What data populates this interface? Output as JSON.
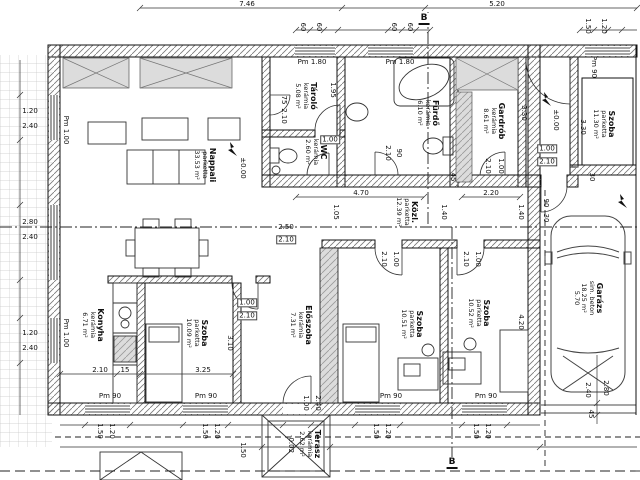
{
  "drawing": {
    "type": "architectural floor plan",
    "level_markers": [
      "±0.00",
      "±0.00",
      "-0.02"
    ],
    "section_marker": "B"
  },
  "colors": {
    "line": "#111111",
    "wall_hatch": "#666666",
    "grey_fill": "#d9d9d9",
    "grid_line": "#c8c8c8"
  },
  "rooms": [
    {
      "name": "Nappali",
      "floor": "parketta",
      "area": "33.53 m²",
      "x": 205,
      "y": 165
    },
    {
      "name": "Tároló",
      "floor": "kerámia",
      "area": "5.08 m²",
      "x": 306,
      "y": 96
    },
    {
      "name": "Fürdő",
      "floor": "kerámia",
      "area": "6.10 m²",
      "x": 428,
      "y": 113
    },
    {
      "name": "WC",
      "floor": "kerámia",
      "area": "2.60 m²",
      "x": 316,
      "y": 152
    },
    {
      "name": "Gardrób",
      "floor": "kerámia",
      "area": "8.61 m²",
      "x": 494,
      "y": 121
    },
    {
      "name": "Szoba",
      "floor": "parketta",
      "area": "11.30 m²",
      "x": 604,
      "y": 124
    },
    {
      "name": "Közl.",
      "floor": "parketta",
      "area": "12.39 m²",
      "x": 407,
      "y": 212
    },
    {
      "name": "Konyha",
      "floor": "kerámia",
      "area": "6.71 m²",
      "x": 93,
      "y": 325
    },
    {
      "name": "Szoba",
      "floor": "parketta",
      "area": "10.09 m²",
      "x": 197,
      "y": 333
    },
    {
      "name": "Előszoba",
      "floor": "kerámia",
      "area": "7.31 m²",
      "x": 301,
      "y": 325
    },
    {
      "name": "Szoba",
      "floor": "parketta",
      "area": "10.51 m²",
      "x": 412,
      "y": 324
    },
    {
      "name": "Szoba",
      "floor": "parketta",
      "area": "10.52 m²",
      "x": 479,
      "y": 313
    },
    {
      "name": "Garázs",
      "floor": "sim. beton",
      "area": "18.25 m²",
      "extra": "5.70",
      "x": 588,
      "y": 298
    },
    {
      "name": "Terasz",
      "floor": "kerámia",
      "area": "2.62 m²",
      "x": 310,
      "y": 444
    }
  ],
  "dimension_texts": [
    {
      "t": "7.46",
      "x": 247,
      "y": 4
    },
    {
      "t": "5.20",
      "x": 497,
      "y": 4
    },
    {
      "t": "B",
      "x": 424,
      "y": 19,
      "cls": "sec"
    },
    {
      "t": "60",
      "x": 303,
      "y": 27,
      "r": 1
    },
    {
      "t": "60",
      "x": 319,
      "y": 27,
      "r": 1
    },
    {
      "t": "60",
      "x": 394,
      "y": 27,
      "r": 1
    },
    {
      "t": "60",
      "x": 410,
      "y": 27,
      "r": 1
    },
    {
      "t": "1.50",
      "x": 588,
      "y": 26,
      "r": 1
    },
    {
      "t": "1.20",
      "x": 604,
      "y": 26,
      "r": 1
    },
    {
      "t": "Pm 90",
      "x": 594,
      "y": 67,
      "r": 1
    },
    {
      "t": "Pm 1.80",
      "x": 312,
      "y": 62
    },
    {
      "t": "Pm 1.80",
      "x": 400,
      "y": 62
    },
    {
      "t": "1.20",
      "x": 30,
      "y": 111
    },
    {
      "t": "2.40",
      "x": 30,
      "y": 126
    },
    {
      "t": "2.80",
      "x": 30,
      "y": 222
    },
    {
      "t": "2.40",
      "x": 30,
      "y": 237
    },
    {
      "t": "1.20",
      "x": 30,
      "y": 333
    },
    {
      "t": "2.40",
      "x": 30,
      "y": 348
    },
    {
      "t": "Pm 1.00",
      "x": 66,
      "y": 130,
      "r": 1
    },
    {
      "t": "Pm 1.00",
      "x": 66,
      "y": 333,
      "r": 1
    },
    {
      "t": "±0.00",
      "x": 243,
      "y": 168,
      "r": 1
    },
    {
      "t": "±0.00",
      "x": 556,
      "y": 120,
      "r": 1
    },
    {
      "t": "75",
      "x": 284,
      "y": 100,
      "r": 1
    },
    {
      "t": "2.10",
      "x": 284,
      "y": 116,
      "r": 1
    },
    {
      "t": "1.95",
      "x": 333,
      "y": 90,
      "r": 1
    },
    {
      "t": "1.00",
      "x": 330,
      "y": 140,
      "cls": "box"
    },
    {
      "t": "2.10",
      "x": 388,
      "y": 153,
      "r": 1
    },
    {
      "t": "90",
      "x": 399,
      "y": 153,
      "r": 1
    },
    {
      "t": "45",
      "x": 453,
      "y": 177,
      "r": 1
    },
    {
      "t": "3.30",
      "x": 524,
      "y": 113,
      "r": 1
    },
    {
      "t": "2.10",
      "x": 488,
      "y": 166,
      "r": 1
    },
    {
      "t": "1.00",
      "x": 501,
      "y": 166,
      "r": 1
    },
    {
      "t": "1.00",
      "x": 547,
      "y": 149,
      "cls": "box"
    },
    {
      "t": "2.10",
      "x": 547,
      "y": 162,
      "cls": "box"
    },
    {
      "t": "3.30",
      "x": 583,
      "y": 127,
      "r": 1
    },
    {
      "t": "30",
      "x": 592,
      "y": 177,
      "r": 1
    },
    {
      "t": "4.70",
      "x": 361,
      "y": 193
    },
    {
      "t": "2.20",
      "x": 491,
      "y": 193
    },
    {
      "t": "1.05",
      "x": 336,
      "y": 212,
      "r": 1
    },
    {
      "t": "1.40",
      "x": 444,
      "y": 212,
      "r": 1
    },
    {
      "t": "1.40",
      "x": 521,
      "y": 212,
      "r": 1
    },
    {
      "t": "90",
      "x": 546,
      "y": 203,
      "r": 1
    },
    {
      "t": "30",
      "x": 546,
      "y": 218,
      "r": 1
    },
    {
      "t": "2.50",
      "x": 286,
      "y": 227
    },
    {
      "t": "2.10",
      "x": 286,
      "y": 240,
      "cls": "box"
    },
    {
      "t": "2.10",
      "x": 384,
      "y": 259,
      "r": 1
    },
    {
      "t": "1.00",
      "x": 396,
      "y": 259,
      "r": 1
    },
    {
      "t": "2.10",
      "x": 466,
      "y": 259,
      "r": 1
    },
    {
      "t": "1.00",
      "x": 478,
      "y": 259,
      "r": 1
    },
    {
      "t": "1.00",
      "x": 247,
      "y": 303,
      "cls": "box"
    },
    {
      "t": "2.10",
      "x": 247,
      "y": 316,
      "cls": "box"
    },
    {
      "t": "2.10",
      "x": 100,
      "y": 370
    },
    {
      "t": "15",
      "x": 125,
      "y": 370
    },
    {
      "t": "3.25",
      "x": 203,
      "y": 370
    },
    {
      "t": "3.10",
      "x": 230,
      "y": 343,
      "r": 1
    },
    {
      "t": "4.20",
      "x": 521,
      "y": 322,
      "r": 1
    },
    {
      "t": "1.00",
      "x": 306,
      "y": 403,
      "r": 1
    },
    {
      "t": "2.40",
      "x": 318,
      "y": 403,
      "r": 1
    },
    {
      "t": "Pm 90",
      "x": 110,
      "y": 396
    },
    {
      "t": "Pm 90",
      "x": 206,
      "y": 396
    },
    {
      "t": "Pm 90",
      "x": 391,
      "y": 396
    },
    {
      "t": "Pm 90",
      "x": 486,
      "y": 396
    },
    {
      "t": "1.50",
      "x": 100,
      "y": 431,
      "r": 1
    },
    {
      "t": "1.20",
      "x": 112,
      "y": 431,
      "r": 1
    },
    {
      "t": "1.50",
      "x": 205,
      "y": 431,
      "r": 1
    },
    {
      "t": "1.20",
      "x": 217,
      "y": 431,
      "r": 1
    },
    {
      "t": "1.50",
      "x": 376,
      "y": 431,
      "r": 1
    },
    {
      "t": "1.20",
      "x": 388,
      "y": 431,
      "r": 1
    },
    {
      "t": "1.50",
      "x": 476,
      "y": 431,
      "r": 1
    },
    {
      "t": "1.20",
      "x": 488,
      "y": 431,
      "r": 1
    },
    {
      "t": "1.50",
      "x": 243,
      "y": 450,
      "r": 1
    },
    {
      "t": "-0.02",
      "x": 291,
      "y": 444,
      "r": 1
    },
    {
      "t": "2.40",
      "x": 588,
      "y": 390,
      "r": 1
    },
    {
      "t": "2.80",
      "x": 606,
      "y": 388,
      "r": 1
    },
    {
      "t": "45",
      "x": 591,
      "y": 414,
      "r": 1
    },
    {
      "t": "B",
      "x": 452,
      "y": 463,
      "cls": "sec"
    }
  ]
}
